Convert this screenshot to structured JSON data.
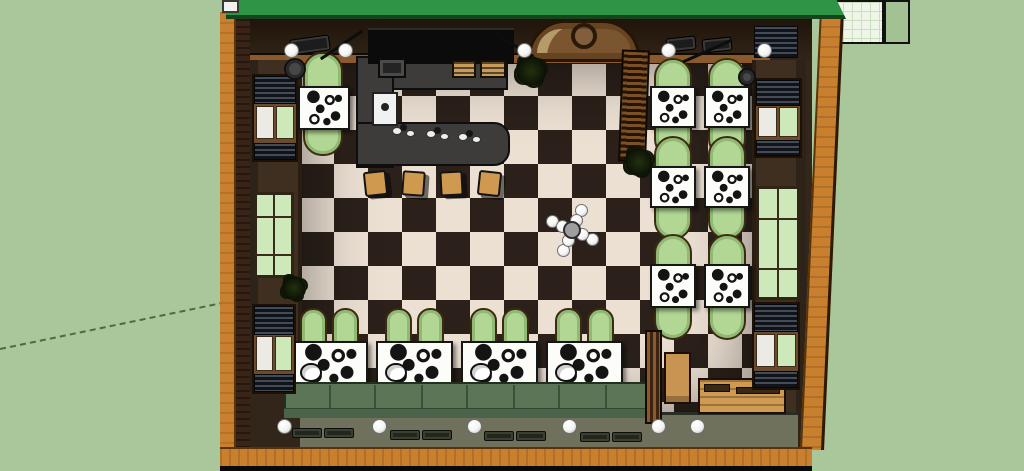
{
  "palette": {
    "bg": "#a9c79a",
    "guide": "#4c6b42",
    "paper": "#eff5e8",
    "paper-line": "#cadfc0",
    "paper-block": "#a3c294",
    "roof": "#2f9443",
    "roof-edge": "#15441d",
    "wood": "#c8802f",
    "brick": "#3a2317",
    "wall-band": "#33261a",
    "plate": "#8a5a2c",
    "side-wall": "#3e2f21",
    "panel-line": "#2a1e12",
    "floor-dark": "#2b211a",
    "floor-light": "#ece0d3",
    "table": "#fcfcf9",
    "ink": "#161616",
    "chair": "#b2d795",
    "chair-ring": "#90ba74",
    "chair-edge": "#3d2a12",
    "bench": "#5c7557",
    "bench-front": "#4a6349",
    "bench-seam": "#3a5038",
    "bar": "#3d3c3a",
    "board": "#0b0b0b",
    "stool": "#cf9950",
    "glass": "#cde9ba",
    "pane": "#eceae4",
    "frame": "#6a4c2c",
    "frame-dark": "#1d1106",
    "blind-a": "#434b54",
    "blind-b": "#10141a",
    "olive": "#70715c",
    "door": "#7a5530",
    "door-trim": "#b59a6a",
    "light": "#f4f4f2",
    "metal": "#9e9e9e"
  },
  "objects": {
    "dining_tables": [
      {
        "x": 298,
        "y": 86,
        "w": 52,
        "h": 44,
        "cap": {
          "x": 303,
          "y": 52,
          "w": 40,
          "h": 104
        }
      },
      {
        "x": 650,
        "y": 86,
        "w": 46,
        "h": 42,
        "cap": {
          "x": 654,
          "y": 58,
          "w": 38,
          "h": 100
        }
      },
      {
        "x": 704,
        "y": 86,
        "w": 46,
        "h": 42,
        "cap": {
          "x": 708,
          "y": 58,
          "w": 38,
          "h": 100
        }
      },
      {
        "x": 650,
        "y": 166,
        "w": 46,
        "h": 42,
        "cap": {
          "x": 654,
          "y": 136,
          "w": 38,
          "h": 104
        }
      },
      {
        "x": 704,
        "y": 166,
        "w": 46,
        "h": 42,
        "cap": {
          "x": 708,
          "y": 136,
          "w": 38,
          "h": 104
        }
      },
      {
        "x": 650,
        "y": 264,
        "w": 46,
        "h": 44,
        "cap": {
          "x": 654,
          "y": 234,
          "w": 38,
          "h": 106
        }
      },
      {
        "x": 704,
        "y": 264,
        "w": 46,
        "h": 44,
        "cap": {
          "x": 708,
          "y": 234,
          "w": 38,
          "h": 106
        }
      }
    ],
    "booth_dims": {
      "y": 341,
      "w": 77,
      "h": 46,
      "chair_y": 308,
      "chair_w": 27,
      "chair_h": 38,
      "chair_off": [
        9,
        41
      ]
    },
    "booths": [
      {
        "x": 291
      },
      {
        "x": 376
      },
      {
        "x": 461
      },
      {
        "x": 546
      }
    ],
    "bench": {
      "x": 284,
      "y": 382,
      "w": 374,
      "h": 36,
      "seams": [
        45,
        90,
        137,
        182,
        229,
        274,
        321
      ]
    },
    "bar": {
      "board": [
        368,
        28,
        146,
        36
      ],
      "back": [
        356,
        56,
        152,
        34
      ],
      "left_arm": [
        356,
        56,
        38,
        112
      ],
      "front_arm": [
        356,
        122,
        154,
        44
      ],
      "sink": [
        372,
        92,
        26,
        34
      ],
      "hood": [
        378,
        58,
        28,
        20
      ],
      "shelves": [
        [
          452,
          60,
          24,
          18
        ],
        [
          480,
          60,
          26,
          18
        ]
      ]
    },
    "bar_dishes": [
      {
        "x": 392,
        "y": 127
      },
      {
        "x": 426,
        "y": 130
      },
      {
        "x": 458,
        "y": 133
      }
    ],
    "bar_stools": {
      "y": 171,
      "w": 23,
      "h": 25,
      "items": [
        {
          "x": 364,
          "r": -6
        },
        {
          "x": 402,
          "r": 4
        },
        {
          "x": 440,
          "r": -3
        },
        {
          "x": 478,
          "r": 6
        }
      ]
    },
    "door": {
      "x": 528,
      "y": 20,
      "w": 112,
      "h": 42,
      "ring": {
        "cx": 584,
        "cy": 36,
        "r": 13
      }
    },
    "slat_bench": {
      "x": 620,
      "y": 50,
      "w": 28,
      "h": 112,
      "r": 2
    },
    "partition": {
      "x": 645,
      "y": 330,
      "w": 17,
      "h": 94
    },
    "crate": {
      "x": 664,
      "y": 352,
      "w": 27,
      "h": 52
    },
    "wood_table": {
      "x": 698,
      "y": 378,
      "w": 88,
      "h": 36
    },
    "wood_items": [
      [
        704,
        384,
        26,
        8
      ],
      [
        736,
        387,
        44,
        7
      ]
    ],
    "windows": [
      {
        "x": 252,
        "y": 74,
        "w": 46,
        "h": 88,
        "kind": "blinds"
      },
      {
        "x": 254,
        "y": 192,
        "w": 40,
        "h": 86,
        "kind": "green"
      },
      {
        "x": 252,
        "y": 304,
        "w": 44,
        "h": 90,
        "kind": "blinds"
      },
      {
        "x": 754,
        "y": 78,
        "w": 48,
        "h": 80,
        "kind": "blinds"
      },
      {
        "x": 756,
        "y": 186,
        "w": 44,
        "h": 114,
        "kind": "green"
      },
      {
        "x": 752,
        "y": 302,
        "w": 48,
        "h": 88,
        "kind": "blinds"
      },
      {
        "x": 754,
        "y": 26,
        "w": 44,
        "h": 32,
        "kind": "slats"
      }
    ],
    "vents": [
      {
        "x": 290,
        "y": 37,
        "w": 40,
        "h": 16,
        "r": -8
      },
      {
        "x": 666,
        "y": 37,
        "w": 30,
        "h": 14,
        "r": -6
      },
      {
        "x": 702,
        "y": 38,
        "w": 30,
        "h": 14,
        "r": -6
      }
    ],
    "plants": [
      {
        "x": 516,
        "y": 56,
        "s": 30
      },
      {
        "x": 625,
        "y": 148,
        "s": 28
      },
      {
        "x": 282,
        "y": 276,
        "s": 24
      }
    ],
    "pots": [
      {
        "x": 284,
        "y": 58,
        "s": 22
      },
      {
        "x": 738,
        "y": 68,
        "s": 18
      }
    ],
    "lights_top": {
      "y": 43,
      "d": 15,
      "xs": [
        284,
        338,
        517,
        661,
        757
      ]
    },
    "lights_bottom": {
      "y": 419,
      "d": 15,
      "xs": [
        277,
        372,
        467,
        562,
        651,
        690
      ]
    },
    "chandelier": {
      "cx": 572,
      "cy": 230,
      "outer": [
        [
          9,
          -20
        ],
        [
          20,
          9
        ],
        [
          -9,
          20
        ],
        [
          -20,
          -9
        ]
      ],
      "inner": [
        [
          4,
          -10
        ],
        [
          10,
          4
        ],
        [
          -4,
          10
        ],
        [
          -10,
          -4
        ]
      ],
      "bulb_d": 13
    },
    "rafters": [
      {
        "x": 340,
        "y": 20,
        "len": 50,
        "r": 56
      },
      {
        "x": 512,
        "y": 22,
        "len": 46,
        "r": -60
      },
      {
        "x": 706,
        "y": 24,
        "len": 54,
        "r": 66
      }
    ],
    "ledge_frames": {
      "w": 30,
      "h": 10,
      "items": [
        [
          292,
          428
        ],
        [
          324,
          428
        ],
        [
          390,
          430
        ],
        [
          422,
          430
        ],
        [
          484,
          431
        ],
        [
          516,
          431
        ],
        [
          580,
          432
        ],
        [
          612,
          432
        ]
      ]
    }
  }
}
